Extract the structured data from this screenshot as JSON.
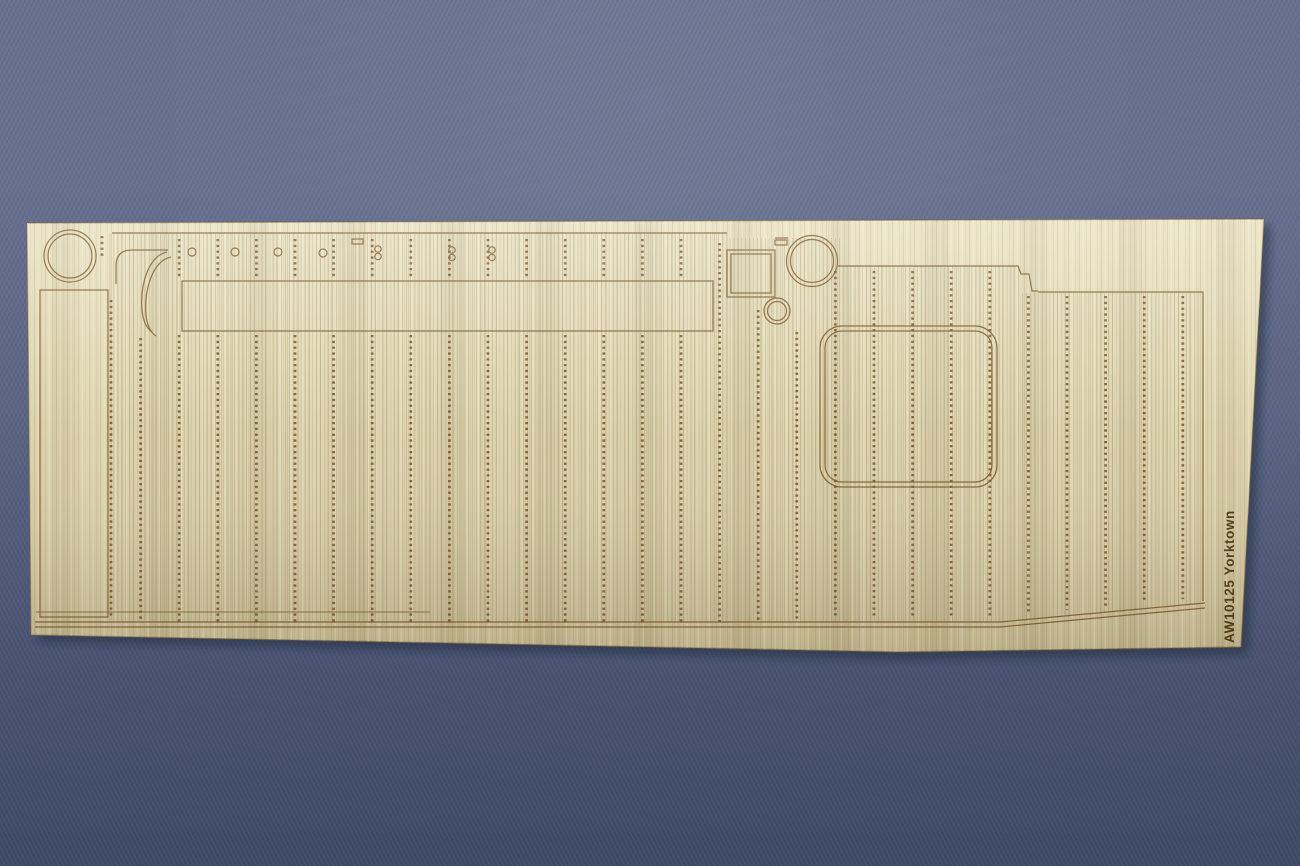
{
  "scene": {
    "description": "Photograph of a laser-etched wooden flight-deck sheet for a ship model kit, lying on blue woven fabric",
    "part_label": "AW10125 Yorktown",
    "part_number": "AW10125",
    "ship_name": "Yorktown"
  },
  "colors": {
    "fabric_top": "#68718f",
    "fabric_mid": "#5b6584",
    "fabric_low": "#4a5472",
    "fabric_bottom": "#3d4965",
    "fabric_dot_light": "#8e96ad",
    "fabric_dot_dark": "#2f3a55",
    "wood_top": "#e8e0c0",
    "wood_mid": "#ddd3ae",
    "wood_bottom": "#cdc19a",
    "wood_grain_dark": "#a4905f",
    "wood_grain_light": "#f4ecce",
    "sheet_edge": "#8a6c42",
    "etch_line": "#7a5a2c",
    "etch_tick": "#6b4c22",
    "plank_line": "#9b8e66",
    "label_text": "#4d3a12",
    "shadow": "#1c2236"
  },
  "etching": {
    "plank_start_x": 110,
    "plank_end_x": 1201,
    "plank_spacing": 3.9,
    "tick_start_x": 102,
    "tick_spacing": 38.6,
    "tick_count": 29,
    "extra_tick_column_x": 111,
    "label_rotation_deg": -90
  }
}
